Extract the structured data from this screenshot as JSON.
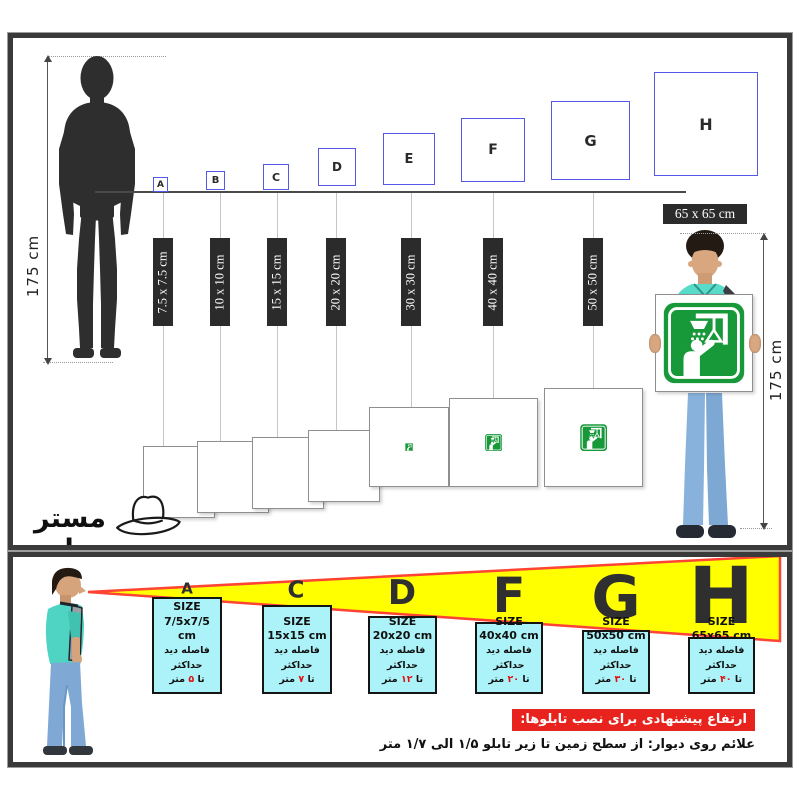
{
  "colors": {
    "sign_green": "#17993a",
    "triangle_yellow": "#ffff00",
    "triangle_border": "#ff4433",
    "box_cyan": "#abf3f8",
    "banner_red": "#e8231e",
    "square_border_blue": "#5558e8",
    "tag_dark": "#2b2b2b",
    "highlight_red": "#e01010"
  },
  "top": {
    "left_height_label": "175 cm",
    "right_height_label": "175 cm",
    "held_sign_size_label": "65 x 65 cm",
    "brand": "مستر راد",
    "square_letters": [
      "A",
      "B",
      "C",
      "D",
      "E",
      "F",
      "G",
      "H"
    ],
    "size_tags": [
      "7.5 x 7.5 cm",
      "10 x 10 cm",
      "15 x 15 cm",
      "20 x 20 cm",
      "30 x 30 cm",
      "40 x 40 cm",
      "50 x 50 cm"
    ]
  },
  "bottom": {
    "triangle_letters": [
      "A",
      "C",
      "D",
      "F",
      "G",
      "H"
    ],
    "size_word": "SIZE",
    "distance_label": "فاصله دید حداکثر",
    "upto": "تا",
    "meter": "متر",
    "boxes": [
      {
        "letter": "A",
        "size": "7/5x7/5 cm",
        "distance": "۵"
      },
      {
        "letter": "C",
        "size": "15x15 cm",
        "distance": "۷"
      },
      {
        "letter": "D",
        "size": "20x20 cm",
        "distance": "۱۲"
      },
      {
        "letter": "F",
        "size": "40x40 cm",
        "distance": "۲۰"
      },
      {
        "letter": "G",
        "size": "50x50 cm",
        "distance": "۳۰"
      },
      {
        "letter": "H",
        "size": "65x65 cm",
        "distance": "۴۰"
      }
    ],
    "banner": "ارتفاع پیشنهادی برای نصب تابلوها:",
    "note": "علائم روی دیوار: از سطح زمین تا زیر تابلو ۱/۵ الی ۱/۷ متر"
  }
}
